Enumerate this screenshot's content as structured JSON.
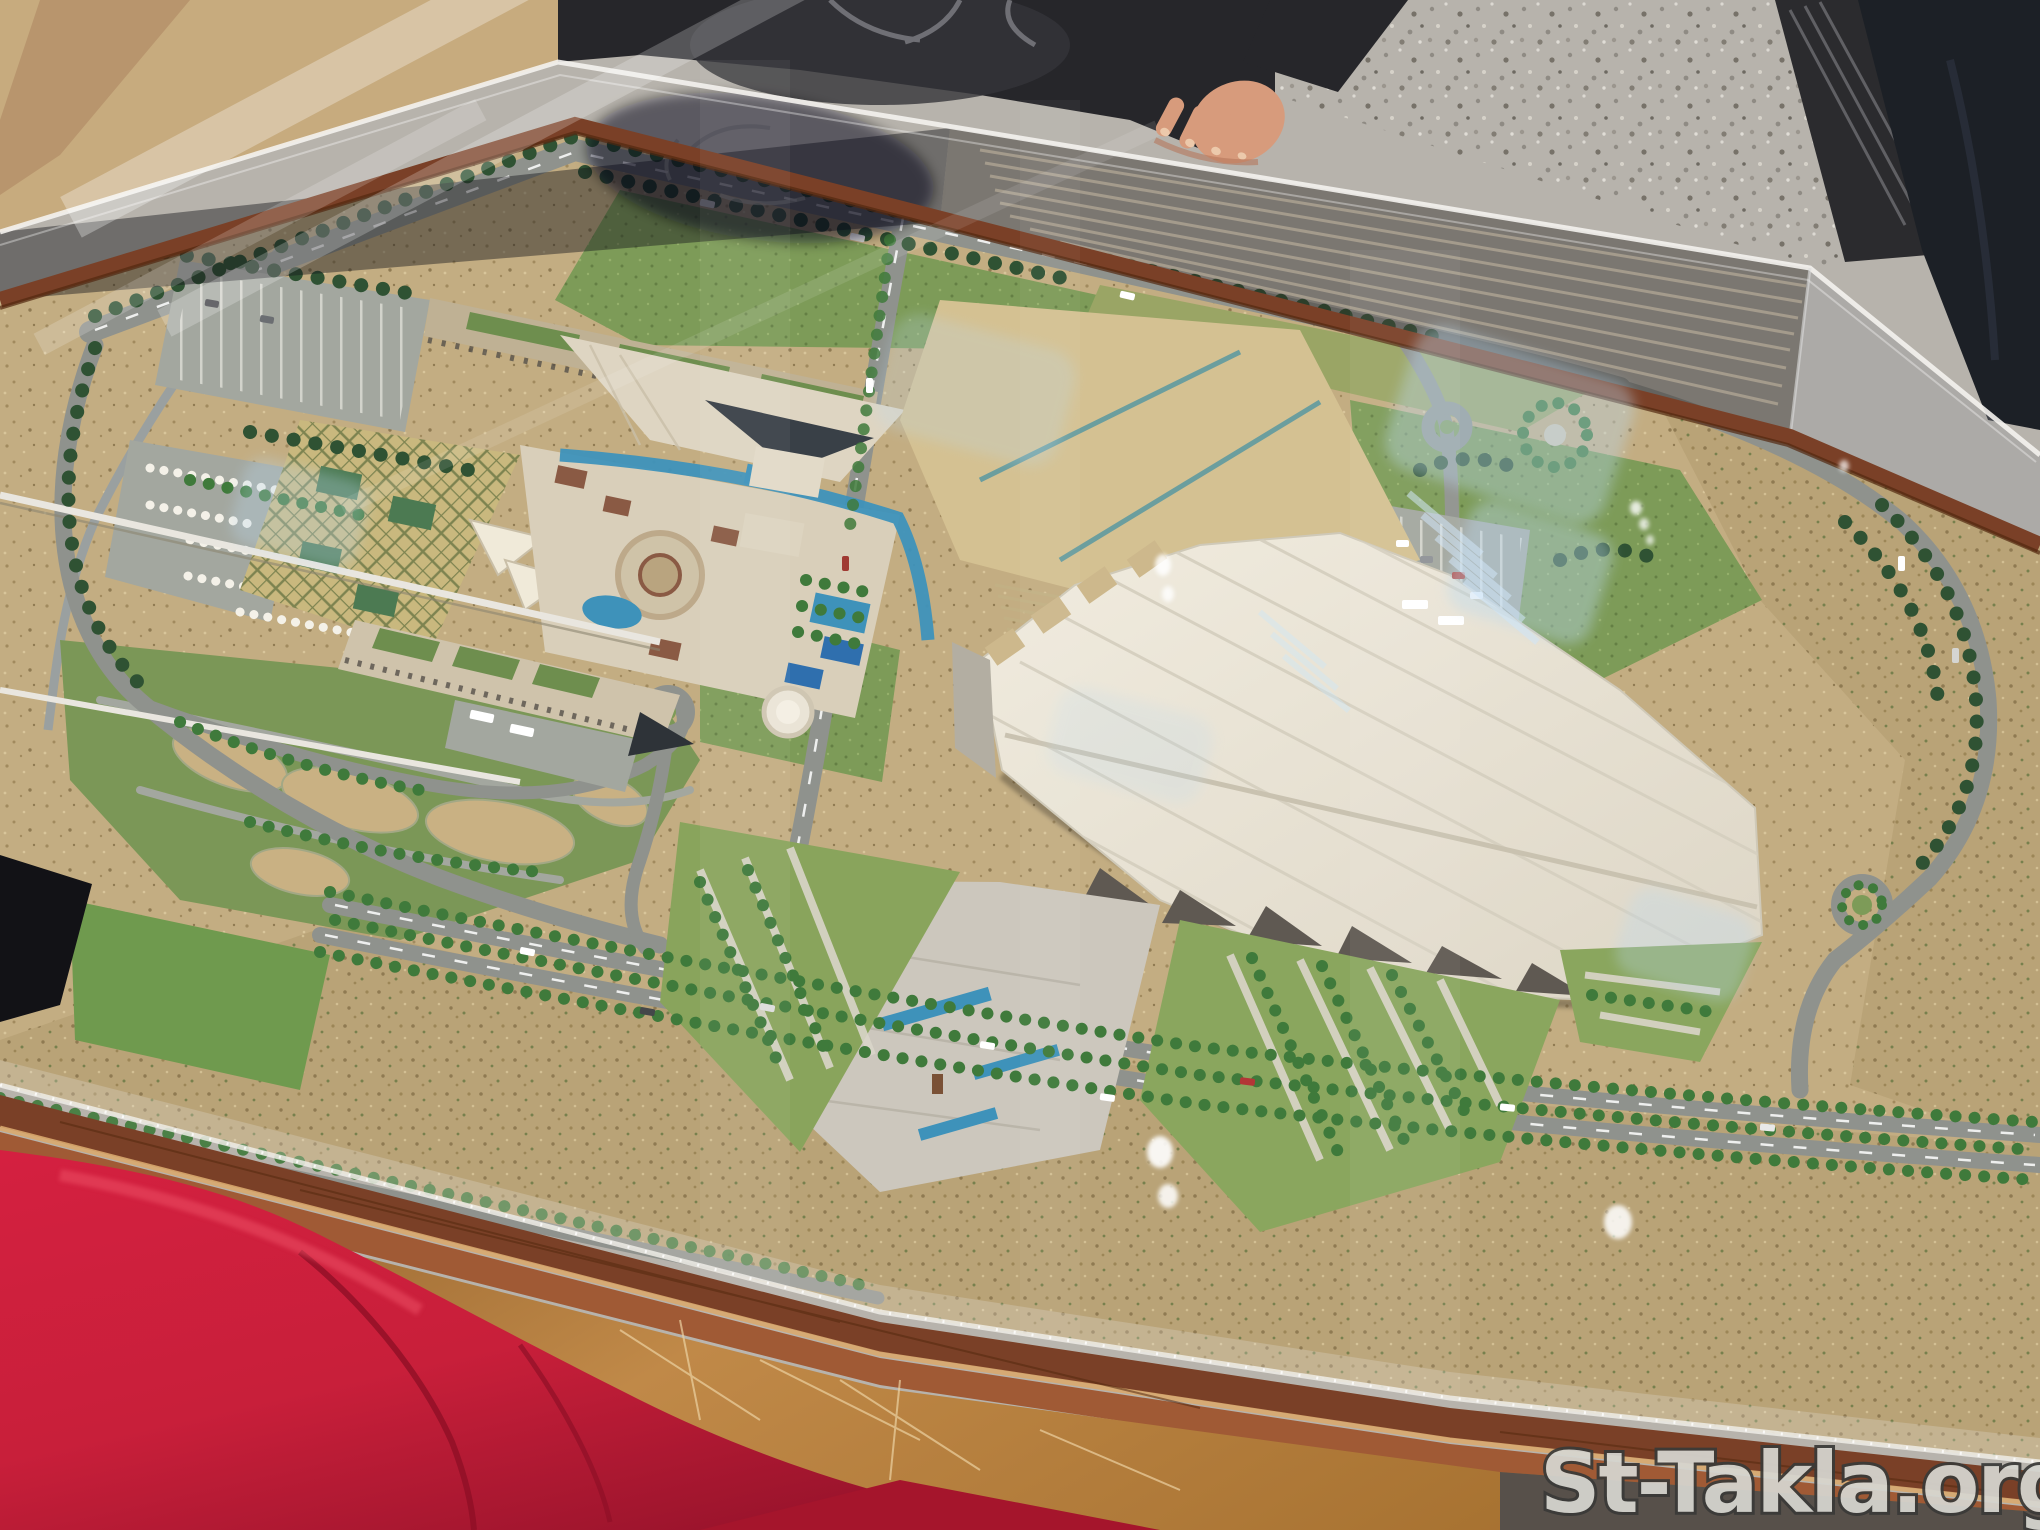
{
  "watermark": {
    "text": "St-Takla.org"
  },
  "scene": {
    "description": "Photograph of an architectural scale model of the Grand Egyptian Museum site under a clear acrylic display case on a wooden table; a visitor in dark clothes rests a hand on the case edge, a red-jacketed visitor stands in the foreground, terrazzo museum floor behind."
  },
  "palette": {
    "floor": "#b7b3ac",
    "floorDark": "#57504a",
    "sand": "#cdb88c",
    "desert": "#c3ad82",
    "scrub": "#b9a377",
    "grass": "#7d9b58",
    "lawnBright": "#6f9a4e",
    "lawnYellow": "#9aa565",
    "road": "#8f928d",
    "roadLight": "#a3a79f",
    "treeDark": "#2f5233",
    "palm": "#3f7a3b",
    "museumRoof": "#ece7da",
    "roofRidge": "#d6d0c0",
    "plazaTan": "#d4c192",
    "canalTeal": "#5f9aa0",
    "pool": "#3e92ba",
    "poolDeep": "#2f6fae",
    "hotelCream": "#d9cfba",
    "hotelTan": "#bfb194",
    "roofGarden": "#6e8e4e",
    "glassPyr": "#394047",
    "gardenOlive": "#c9b87e",
    "diamondLine": "#6f7a48",
    "woodRim": "#7a4027",
    "woodRimDark": "#53280f",
    "woodRim2": "#a05a35",
    "apron": "#bf8844",
    "apronScratch": "#ecd2a2",
    "shadowDark": "#2a2622",
    "personDark": "#26262a",
    "sleeveDark": "#1f1f23",
    "skin": "#d79b7c",
    "skinShadow": "#b5775c",
    "nail": "#ecc9ab",
    "legNavy": "#1c2026",
    "frameDark": "#2b2b2e",
    "frameGroove": "#6e6e72",
    "garmentRed": "#c81f3a",
    "garmentRedDark": "#8e0f26",
    "garmentRedLight": "#ef5268",
    "pantsDark": "#191d24",
    "shoeNavy": "#42526e",
    "shoeCollar": "#7e94b5",
    "shoeSole": "#ddd9d2",
    "shoeRed": "#c23333",
    "reflectionBlue": "#bcd9ef",
    "reflectionBar": "#cfe6f7",
    "hazyTan": "#c7ab7e",
    "hazyBand": "#b5916a",
    "chaletWhite": "#f4f1e8",
    "courtGreen": "#4c7a52",
    "pyramidWhite": "#f0ead9",
    "domeWhite": "#eae4d6",
    "watermarkFill": "#d6d6d0",
    "watermarkStroke": "#3a3a38"
  }
}
